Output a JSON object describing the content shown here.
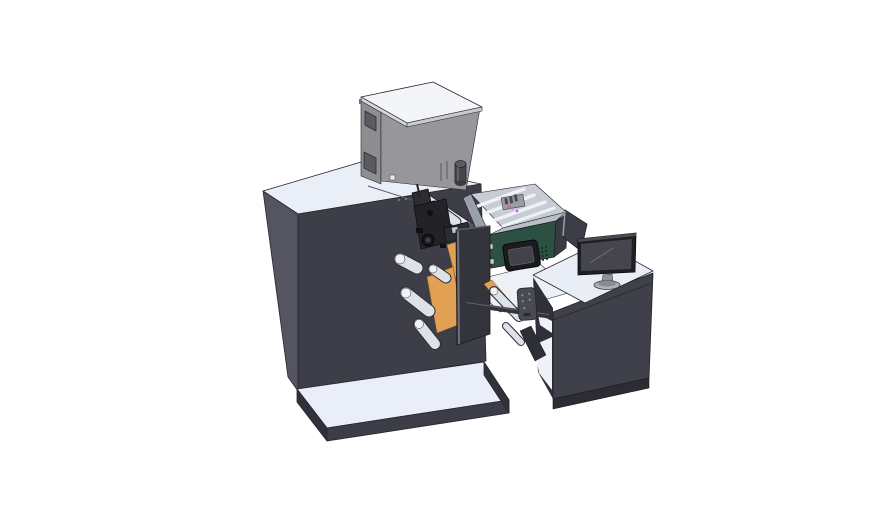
{
  "scene": {
    "background": "#ffffff"
  },
  "colors": {
    "background": "#ffffff",
    "outline": "#26262c",
    "machine_top": "#eaeef7",
    "machine_left": "#555561",
    "machine_front": "#3e3e48",
    "seam": "#5a5a64",
    "screw": "#8a8a90",
    "platform_top": "#e9eef8",
    "platform_front": "#3d3d48",
    "platform_side": "#31313b",
    "box_top": "#f3f5f8",
    "box_left": "#8d8d92",
    "box_front": "#97979b",
    "box_lid_edge_left": "#d5d8dc",
    "box_lid_edge_right": "#c7cacf",
    "box_window": "#5a5a62",
    "box_vent": "#6e6e73",
    "box_square": "#e8eaee",
    "cylinder_body": "#46464e",
    "cylinder_top": "#5a5a63",
    "cylinder_base": "#3a3a41",
    "cylinder_highlight": "#6b6b74",
    "rail_light": "#e8ebf1",
    "rail_cap": "#55555e",
    "roller_light": "#dde1e8",
    "roller_outline": "#2c2c32",
    "roller_end": "#f0f2f6",
    "head_dark": "#222228",
    "head_mid": "#2c2c33",
    "head_black": "#101014",
    "head_detail": "#c8ccd2",
    "head_hub": "#15151a",
    "head_hub_inner": "#3e3e46",
    "orange": "#e2a054",
    "orange_edge": "#8a5f28",
    "door_panel": "#34343d",
    "door_edge": "#70707a",
    "door_top": "#5a5a64",
    "shelf_top": "#edf0f7",
    "tray_interior": "#c7ccd5",
    "tray_rail": "#eef1f6",
    "tray_wall_top": "#b9bec7",
    "tray_left_cap": "#9aa0a9",
    "tray_right_wall": "#3a3a43",
    "tray_item": "#9b9ba2",
    "tray_item_dark": "#4a4a52",
    "magenta": "#c95fc9",
    "purple": "#a86fc8",
    "green_panel": "#2d5044",
    "display_bezel": "#1b1b20",
    "display_screen": "#42424b",
    "display_screen_edge": "#5c5c66",
    "display_tab": "#c9cdd4",
    "green_dot": "#1a2620",
    "desk_top": "#e9edf6",
    "desk_front": "#40404a",
    "desk_left": "#30303a",
    "desk_kick": "#2c2c34",
    "desk_seam": "#2b2b33",
    "shelf_white": "#eef1f7",
    "deflector": "#3d3d47",
    "deflector_edge": "#9aa0aa",
    "monitor_bezel": "#1f1f24",
    "monitor_top_edge": "#4a4a52",
    "monitor_screen": "#45454e",
    "monitor_glare": "#6d6d77",
    "monitor_stand": "#8e939b",
    "monitor_base": "#aeb3bb",
    "monitor_base_inner": "#878d95",
    "beam": "#33333c",
    "beam_highlight": "#63636d",
    "pendant_body": "#4a4a53",
    "pendant_dot": "#9a9aa2",
    "pendant_slot": "#2a2a30",
    "dark_piece": "#2e2e36"
  },
  "parts": {
    "machine": "main printing machine cabinet",
    "supply_box": "electronics box on machine top",
    "print_unit": "print head with web rollers and guide plates",
    "tray": "open component tray with control panel",
    "display": "control panel display",
    "desk": "operator desk",
    "monitor": "desktop monitor",
    "pendant": "hand-held control pendant",
    "platform": "floor base platform"
  }
}
